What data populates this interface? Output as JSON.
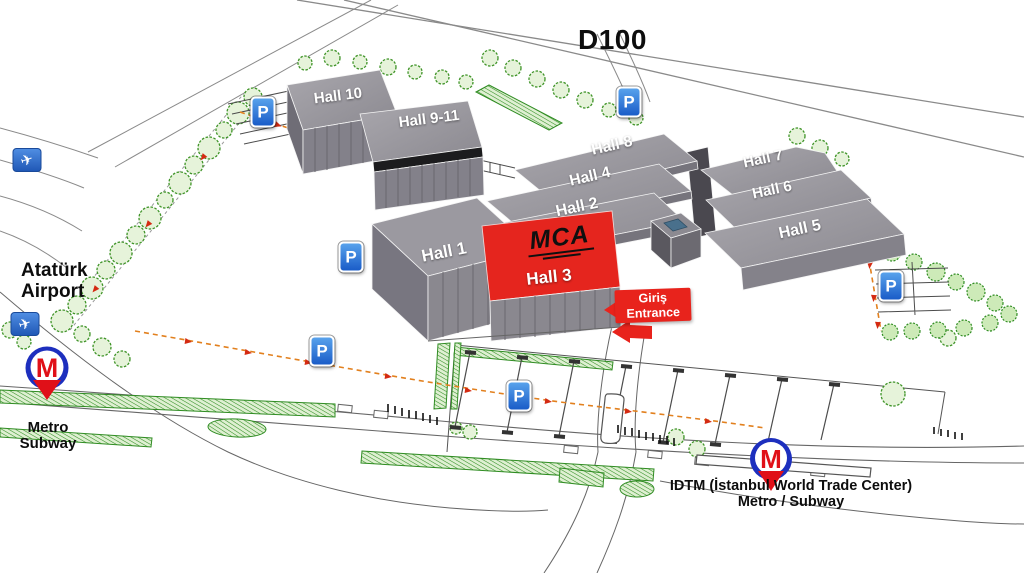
{
  "map": {
    "highway_label": "D100",
    "parking_label": "P",
    "plane_glyph": "✈",
    "metro_m": "M",
    "halls": [
      {
        "id": "hall-10",
        "label": "Hall 10"
      },
      {
        "id": "hall-9-11",
        "label": "Hall 9-11"
      },
      {
        "id": "hall-8",
        "label": "Hall 8"
      },
      {
        "id": "hall-4",
        "label": "Hall 4"
      },
      {
        "id": "hall-2",
        "label": "Hall 2"
      },
      {
        "id": "hall-7",
        "label": "Hall 7"
      },
      {
        "id": "hall-6",
        "label": "Hall 6"
      },
      {
        "id": "hall-5",
        "label": "Hall 5"
      },
      {
        "id": "hall-1",
        "label": "Hall 1"
      },
      {
        "id": "hall-3",
        "label": "Hall 3",
        "highlighted": true
      }
    ],
    "hall3_logo_text": "MCA",
    "entrance": {
      "line1": "Giriş",
      "line2": "Entrance"
    },
    "airport_label": {
      "line1": "Atatürk",
      "line2": "Airport"
    },
    "metro_left_label": {
      "line1": "Metro",
      "line2": "Subway"
    },
    "metro_right_label": {
      "line1": "IDTM (İstanbul World Trade Center)",
      "line2": "Metro / Subway"
    },
    "colors": {
      "hall_gray": "#97959c",
      "hall_highlight_red": "#e5251e",
      "parking_blue": "#1f63c8",
      "metro_blue": "#1d2fbe",
      "metro_red": "#e01018",
      "landscape_green": "#3f9428",
      "entrance_red": "#e8231c"
    }
  }
}
